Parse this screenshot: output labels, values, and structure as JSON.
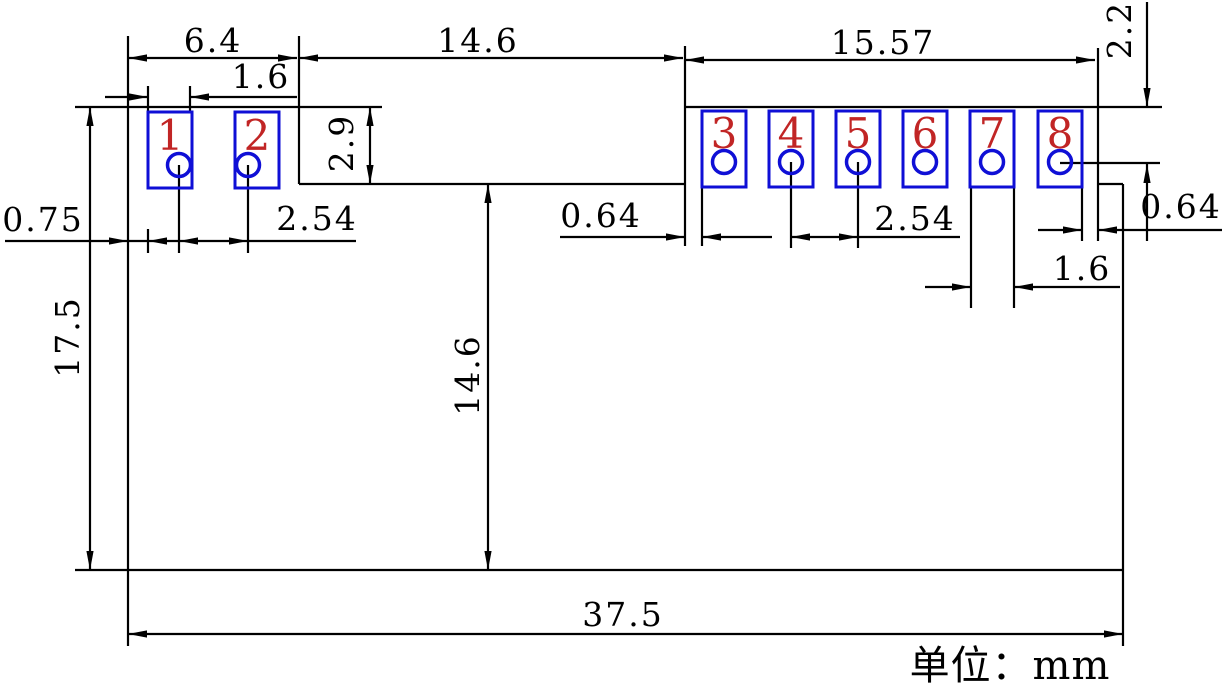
{
  "unit_note": "单位：mm",
  "pad_numbers": [
    "1",
    "2",
    "3",
    "4",
    "5",
    "6",
    "7",
    "8"
  ],
  "dimensions": {
    "top_left_width": "6.4",
    "pad1_width": "1.6",
    "top_middle_width": "14.6",
    "top_right_width": "15.57",
    "right_top_offset": "2.2",
    "pad_area_height": "2.9",
    "left_edge_to_pad": "0.75",
    "left_pin_pitch": "2.54",
    "middle_gap": "0.64",
    "right_pin_pitch": "2.54",
    "right_gap": "0.64",
    "pad7_width": "1.6",
    "total_height": "17.5",
    "lower_body_height": "14.6",
    "total_width": "37.5"
  },
  "colors": {
    "pad_outline": "#0f0fd6",
    "pad_number": "#c12525",
    "line": "#000000"
  }
}
